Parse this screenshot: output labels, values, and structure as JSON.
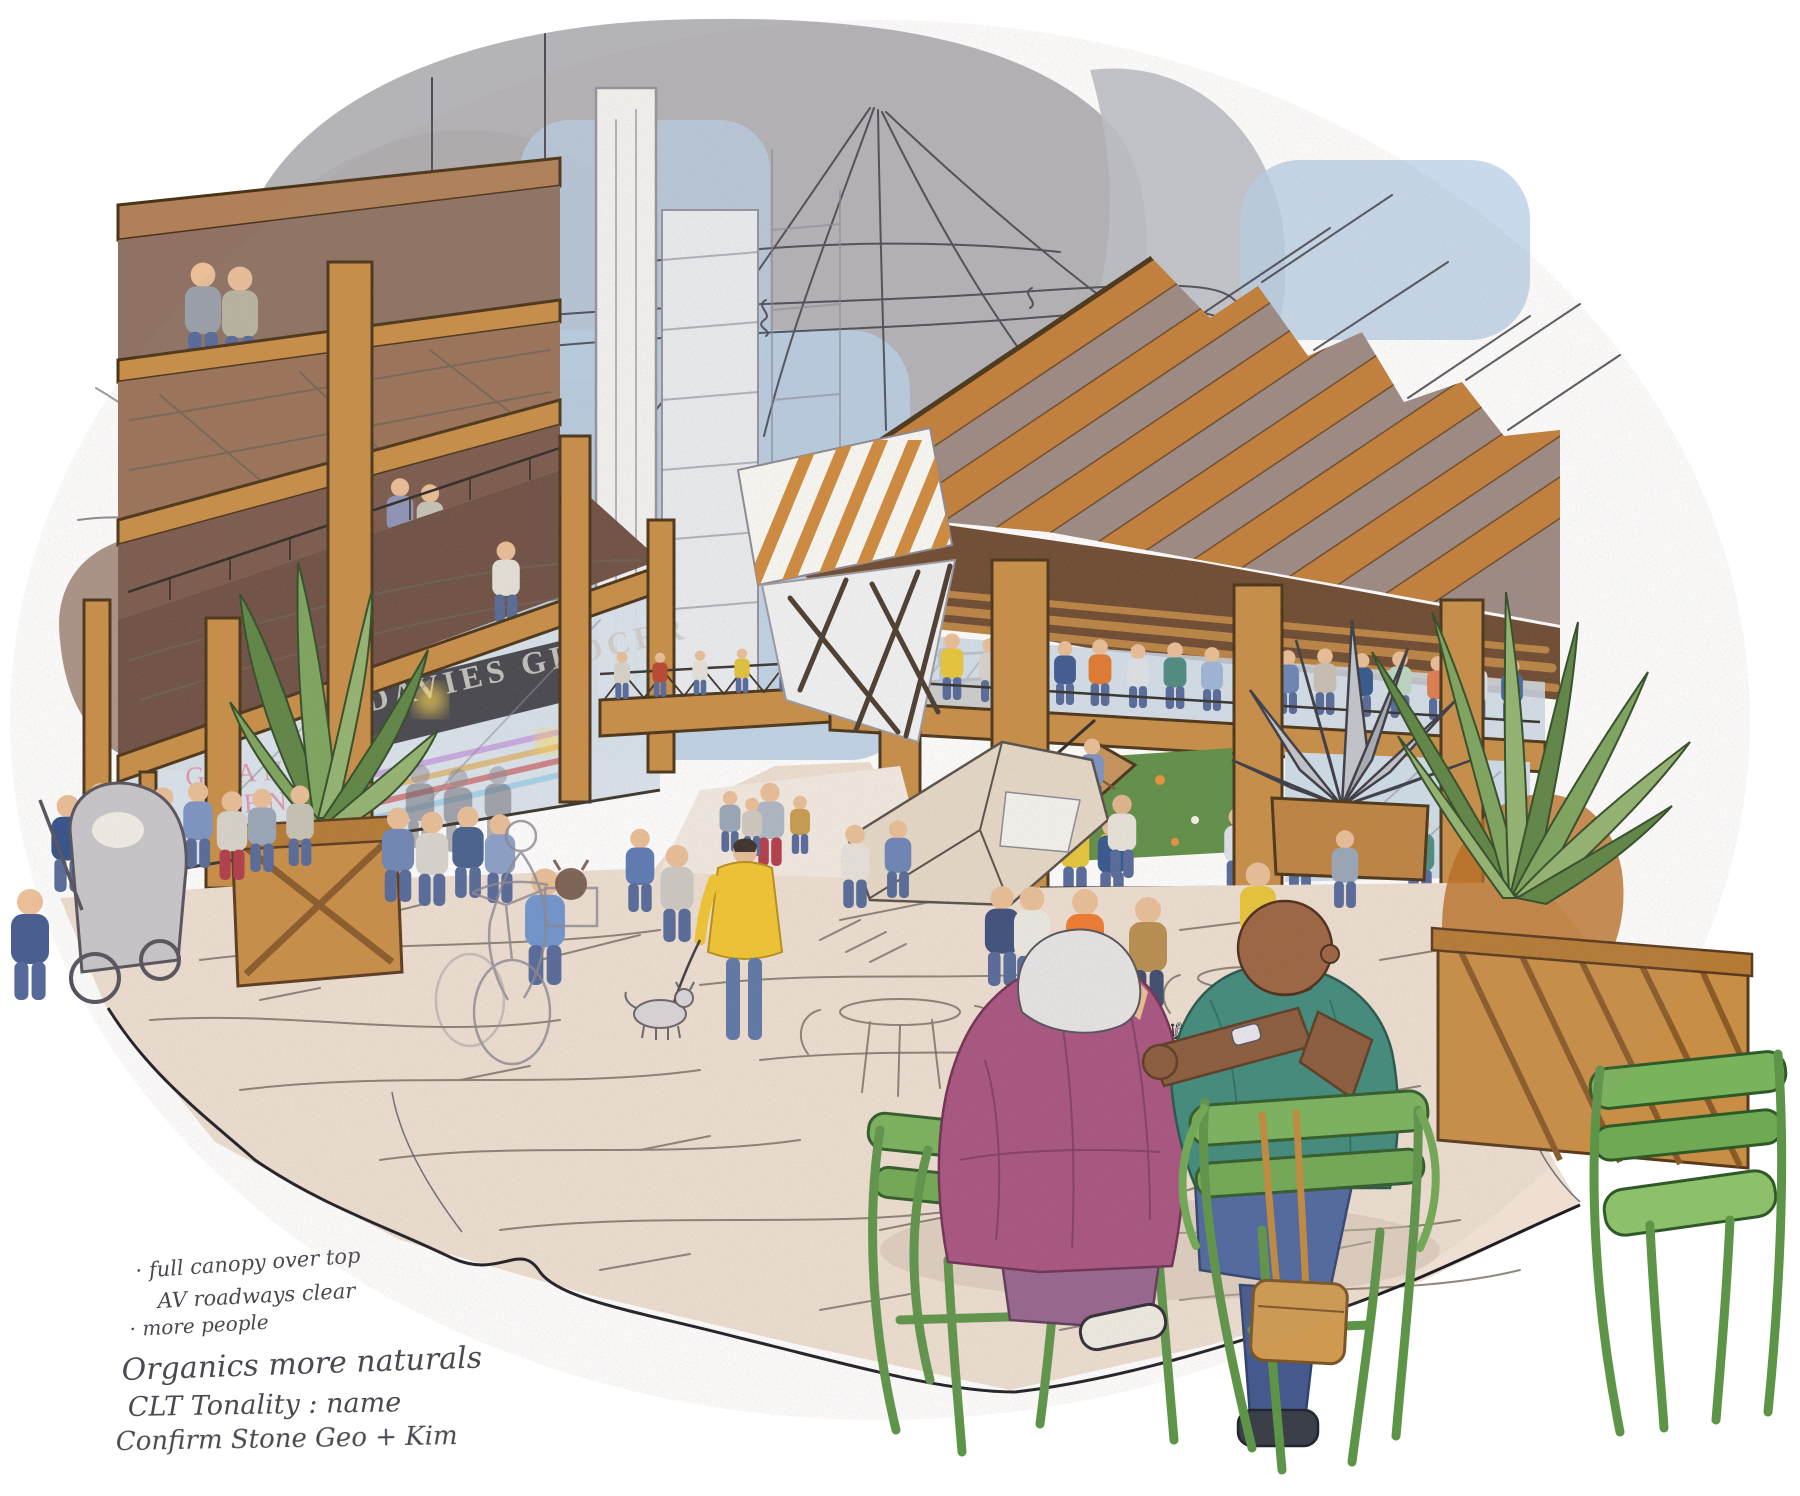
{
  "scene": {
    "description": "Hand-drawn architectural concept illustration (line work with colored-pencil washes) of a mass-timber neighbourhood plaza. A left timber building with balconies and a ground-floor grocer faces a large open timber pavilion on the right with a striped sloped roof and a crowded mezzanine. A pedestrian bridge and stair connect the buildings over a busy pedestrian plaza. In the foreground two elderly men play chess at a small grey table surrounded by green bistro chairs. Wooden planters hold large tropical plants and a spiky metal agave sculpture. A sketched cable-net canopy and faint towers fill the sky; washes fade to white paper at the edges. Handwritten design notes sit at bottom left.",
    "elements": [
      "grey and tan watercolor washes, blue sky wash",
      "scribbled cable-net canopy sketch lines",
      "faint background towers",
      "left mass-timber building with balconies and couple standing above",
      "DAVIES GROCER storefront with GRAND OPENING window sign and warm lights",
      "pedestrian truss bridge with walkers, stair to pavilion",
      "right timber pavilion: orange and mauve striped roof, crowded mezzanine, green mural, glass walls",
      "spiky metal agave sculpture in wood planter",
      "large leafy plants in cross-braced wood planters",
      "plaza crowd: dog walker in yellow coat, ghost-sketch cyclist with dog in basket, stroller, shoppers, orange safety vest, yellow raincoat, red boots",
      "foreground chess match: white-haired man in magenta jacket vs bald man in teal shirt, green Luxembourg chairs, tan tote bag",
      "sketch-only cafe tables and chairs on plaza",
      "handwritten cursive design notes, bottom left"
    ]
  },
  "signs": {
    "grocer": "DAVIES GROCER",
    "grand": "GRAND",
    "opening": "OPENING"
  },
  "notes": {
    "lines": [
      "· full canopy over top",
      "AV roadways clear",
      "· more people",
      "Organics more naturals",
      "CLT Tonality : name",
      "Confirm Stone Geo + Kim"
    ]
  },
  "chess": {
    "black_pieces": "♟♜♞♛♟",
    "white_pieces": "♙♕♔♗♙",
    "tall_piece": "♕"
  },
  "palette": {
    "paper": "#ffffff",
    "grey_wash": "#aeacb2",
    "tan_wash": "#c7ad92",
    "sky_blue": "#b9cfe6",
    "timber_orange": "#c98e46",
    "roof_mauve": "#9d8a84",
    "soffit_brown": "#9b7258",
    "plaza_beige": "#eedfd2",
    "chair_green": "#79b35c",
    "jacket_magenta": "#a8537f",
    "shirt_teal": "#3f8a7b",
    "jeans_blue": "#4e67a0",
    "coat_yellow": "#f2c531",
    "plant_green": "#7da55e",
    "amber_wash": "#b96a1e",
    "ink": "#2f2d36"
  }
}
